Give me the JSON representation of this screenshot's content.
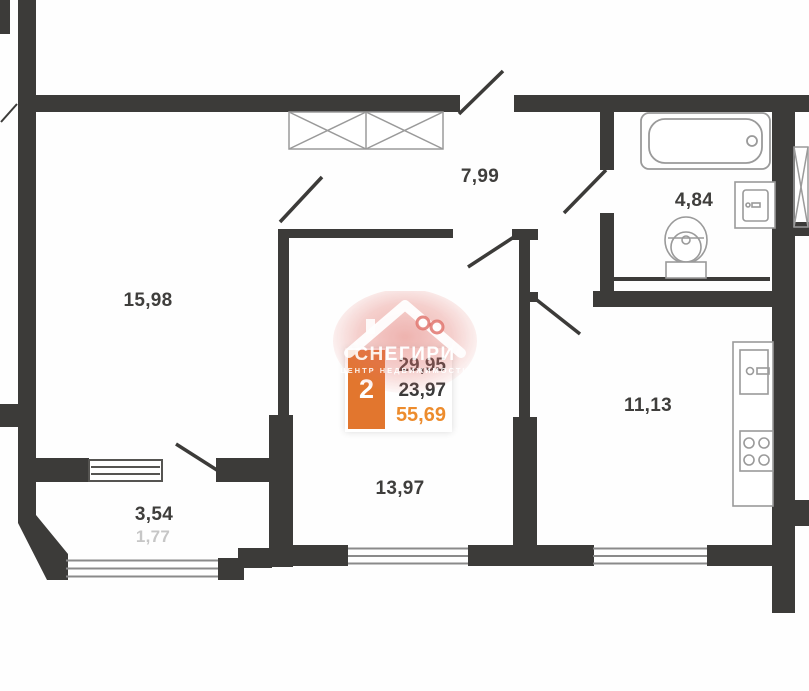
{
  "plan": {
    "title": "2-room apartment floor plan",
    "rooms": [
      {
        "name": "bedroom",
        "area": "15,98"
      },
      {
        "name": "hallway",
        "area": "7,99"
      },
      {
        "name": "bathroom",
        "area": "4,84"
      },
      {
        "name": "kitchen",
        "area": "11,13"
      },
      {
        "name": "living-room",
        "area": "13,97"
      },
      {
        "name": "balcony",
        "area": "3,54"
      },
      {
        "name": "balcony-reduced",
        "area": "1,77"
      }
    ],
    "info_card": {
      "rooms_count": "2",
      "area_line1": "29,95",
      "area_line2": "23,97",
      "area_total": "55,69"
    },
    "watermark": {
      "title": "СНЕГИРИ",
      "subtitle": "ЦЕНТР НЕДВИЖИМОСТИ"
    },
    "colors": {
      "wall": "#3c3b39",
      "fixture_stroke": "#9a9a9a",
      "window_stroke": "#8a8a8a",
      "accent_orange": "#e2762e",
      "total_orange": "#ed8c2d",
      "muted_label": "#c6c6c6",
      "watermark_pink": "#e2736b"
    }
  }
}
